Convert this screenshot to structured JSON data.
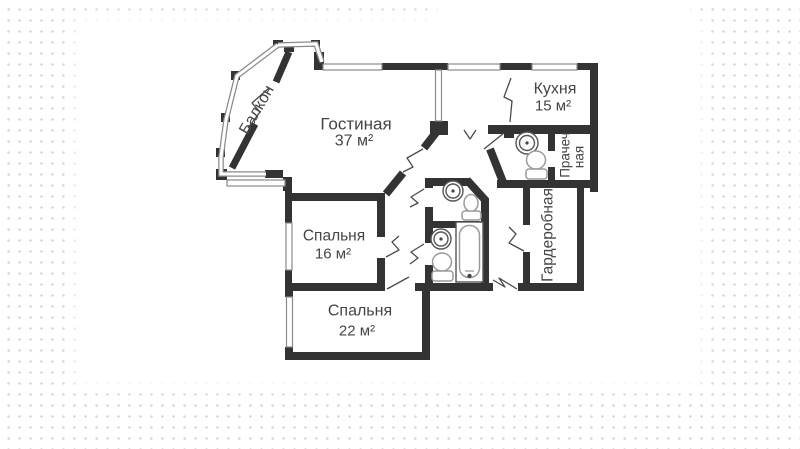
{
  "plan": {
    "rooms": {
      "living": {
        "label": "Гостиная",
        "area": "37 м²"
      },
      "kitchen": {
        "label": "Кухня",
        "area": "15 м²"
      },
      "bedroom_small": {
        "label": "Спальня",
        "area": "16 м²"
      },
      "bedroom_large": {
        "label": "Спальня",
        "area": "22 м²"
      },
      "balcony": {
        "label": "Балкон"
      },
      "laundry": {
        "label_line1": "Прачеч",
        "label_line2": "ная"
      },
      "wardrobe": {
        "label": "Гардеробная"
      }
    },
    "colors": {
      "wall": "#333333",
      "window_line": "#8a8a8a",
      "door_line": "#4a4a4a",
      "fixture_line": "#9b9b9b",
      "text": "#454545",
      "background_dots": "#d2d2d2",
      "paper": "#ffffff"
    }
  }
}
